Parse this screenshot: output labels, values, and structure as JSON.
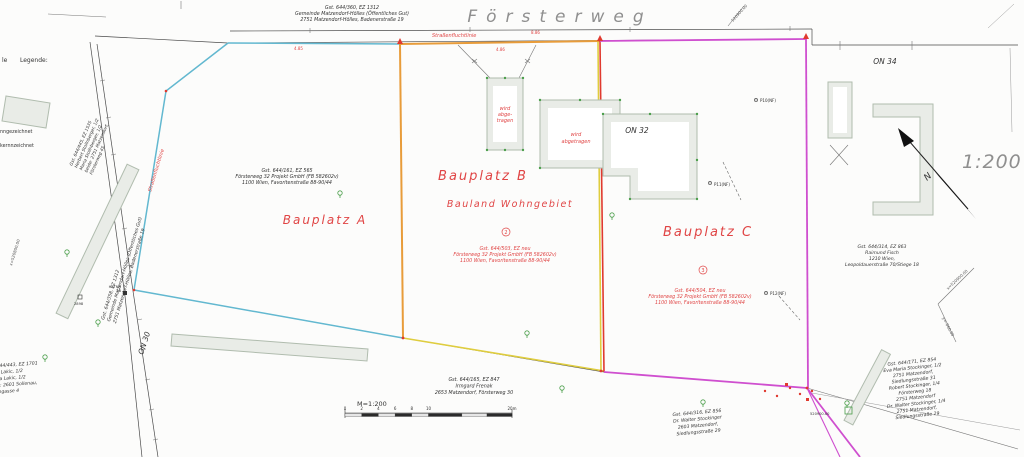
{
  "street": {
    "name": "Försterweg"
  },
  "scale": {
    "ratio_large": "1:200",
    "bar_label": "M=1:200",
    "ticks": [
      "0",
      "2",
      "4",
      "6",
      "8",
      "10",
      "20m"
    ],
    "north_letter": "N"
  },
  "legend": {
    "partial_prefix": "le",
    "title": "Legende:",
    "partial_lines": [
      "nngezeichnet",
      "kernnzeichnet"
    ]
  },
  "plots": {
    "a": {
      "label": "Bauplatz A",
      "owner": [
        "Gst. 644/161, EZ 565",
        "Försterweg 32 Projekt GmbH (FB 582602v)",
        "1100 Wien, Favoritenstraße 88-90/44"
      ]
    },
    "b": {
      "label": "Bauplatz B",
      "zone": "Bauland Wohngebiet",
      "number": "2",
      "owner": [
        "Gst. 644/503, EZ neu",
        "Försterweg 32 Projekt GmbH (FB 582602v)",
        "1100 Wien, Favoritenstraße 88-90/44"
      ]
    },
    "c": {
      "label": "Bauplatz C",
      "number": "3",
      "owner": [
        "Gst. 644/504, EZ neu",
        "Försterweg 32 Projekt GmbH (FB 582602v)",
        "1100 Wien, Favoritenstraße 88-90/44"
      ]
    }
  },
  "buildings": {
    "demolish_small": [
      "wird",
      "abge-",
      "tragen"
    ],
    "demolish_mid": [
      "wird",
      "abgetragen"
    ],
    "on32": "ON 32",
    "on34": "ON 34",
    "on30": "ON 30"
  },
  "annotations": {
    "street_alignment_top": "Straßenfluchtlinie",
    "street_alignment_left": "Straßenfluchtlinie",
    "dim1": "8.86",
    "dim2": "4.86",
    "dim3": "4.85"
  },
  "neighbors": {
    "street_parcel_top": [
      "Gst. 644/360, EZ 1312",
      "Gemeinde Matzendorf-Hölles (Öffentliches Gut)",
      "2751 Matzendorf-Hölles, Badenerstraße 19"
    ],
    "street_parcel_left": [
      "Gst. 644/358, EZ 1312",
      "Gemeinde Matzendorf-Hölles (Öffentliches Gut)",
      "2751 Matzendorf-Hölles, Badenerstraße 19"
    ],
    "upper_left": [
      "Gst. 644/445, EZ 1535",
      "Herbert Stollnberger, 1/2",
      "Maria Stollnberger, 1/2",
      "beide: 2751 Matzendorf,",
      "Försterweg 45"
    ],
    "lower_left": [
      "Gst. 644/443, EZ 1701",
      "Bojan Lakic, 1/2",
      "Jovana Lakic, 1/2",
      "beide: 2601 Sollenau,",
      "Braungasse 4"
    ],
    "bottom_center": [
      "Gst. 644/165, EZ 847",
      "Irmgard Frenak",
      "2653 Matzendorf, Försterweg 30"
    ],
    "bottom_right_small": [
      "Gst. 644/316, EZ 856",
      "Dr. Walter Stockinger",
      "2603 Matzendorf,",
      "Siedlungsstraße 29"
    ],
    "right": [
      "Gst. 644/314, EZ 863",
      "Raimund Fisch",
      "1210 Wien,",
      "Leopoldauerstraße 70/Stiege 18"
    ],
    "bottom_right_large": [
      "Gst. 644/171, EZ 854",
      "Eva Maria Stockinger, 1/2",
      "2751 Matzendorf,",
      "Siedlungsstraße 31",
      "Robert Stockinger, 1/4",
      "Försterweg 18",
      "2751 Matzendorf",
      "Dr. Walter Stockinger, 1/4",
      "2751 Matzendorf,",
      "Siedlungsstraße 29"
    ]
  },
  "points": {
    "p10": "P10(NF)",
    "p11": "P11(NF)",
    "p12": "P12(NF)",
    "pt2898": "2898",
    "hstnr_line1": "HSTNR",
    "hstnr_line2": "48",
    "corner_coord": "520900.00"
  },
  "coords": {
    "right_x": "x=520900.00",
    "right_y": "y=-060.00",
    "left": "x=520800.00",
    "top": "520900.00"
  },
  "colors": {
    "plot_a": "#62b8d0",
    "plot_b_left": "#e89c3a",
    "plot_b_right": "#dfcd3e",
    "boundary_red": "#e03a2f",
    "plot_c": "#cf4fcf",
    "building_fill": "#e9ece7",
    "building_stroke": "#b0bcae",
    "green_mark": "#4a9e4a",
    "red_text": "#e04545"
  }
}
